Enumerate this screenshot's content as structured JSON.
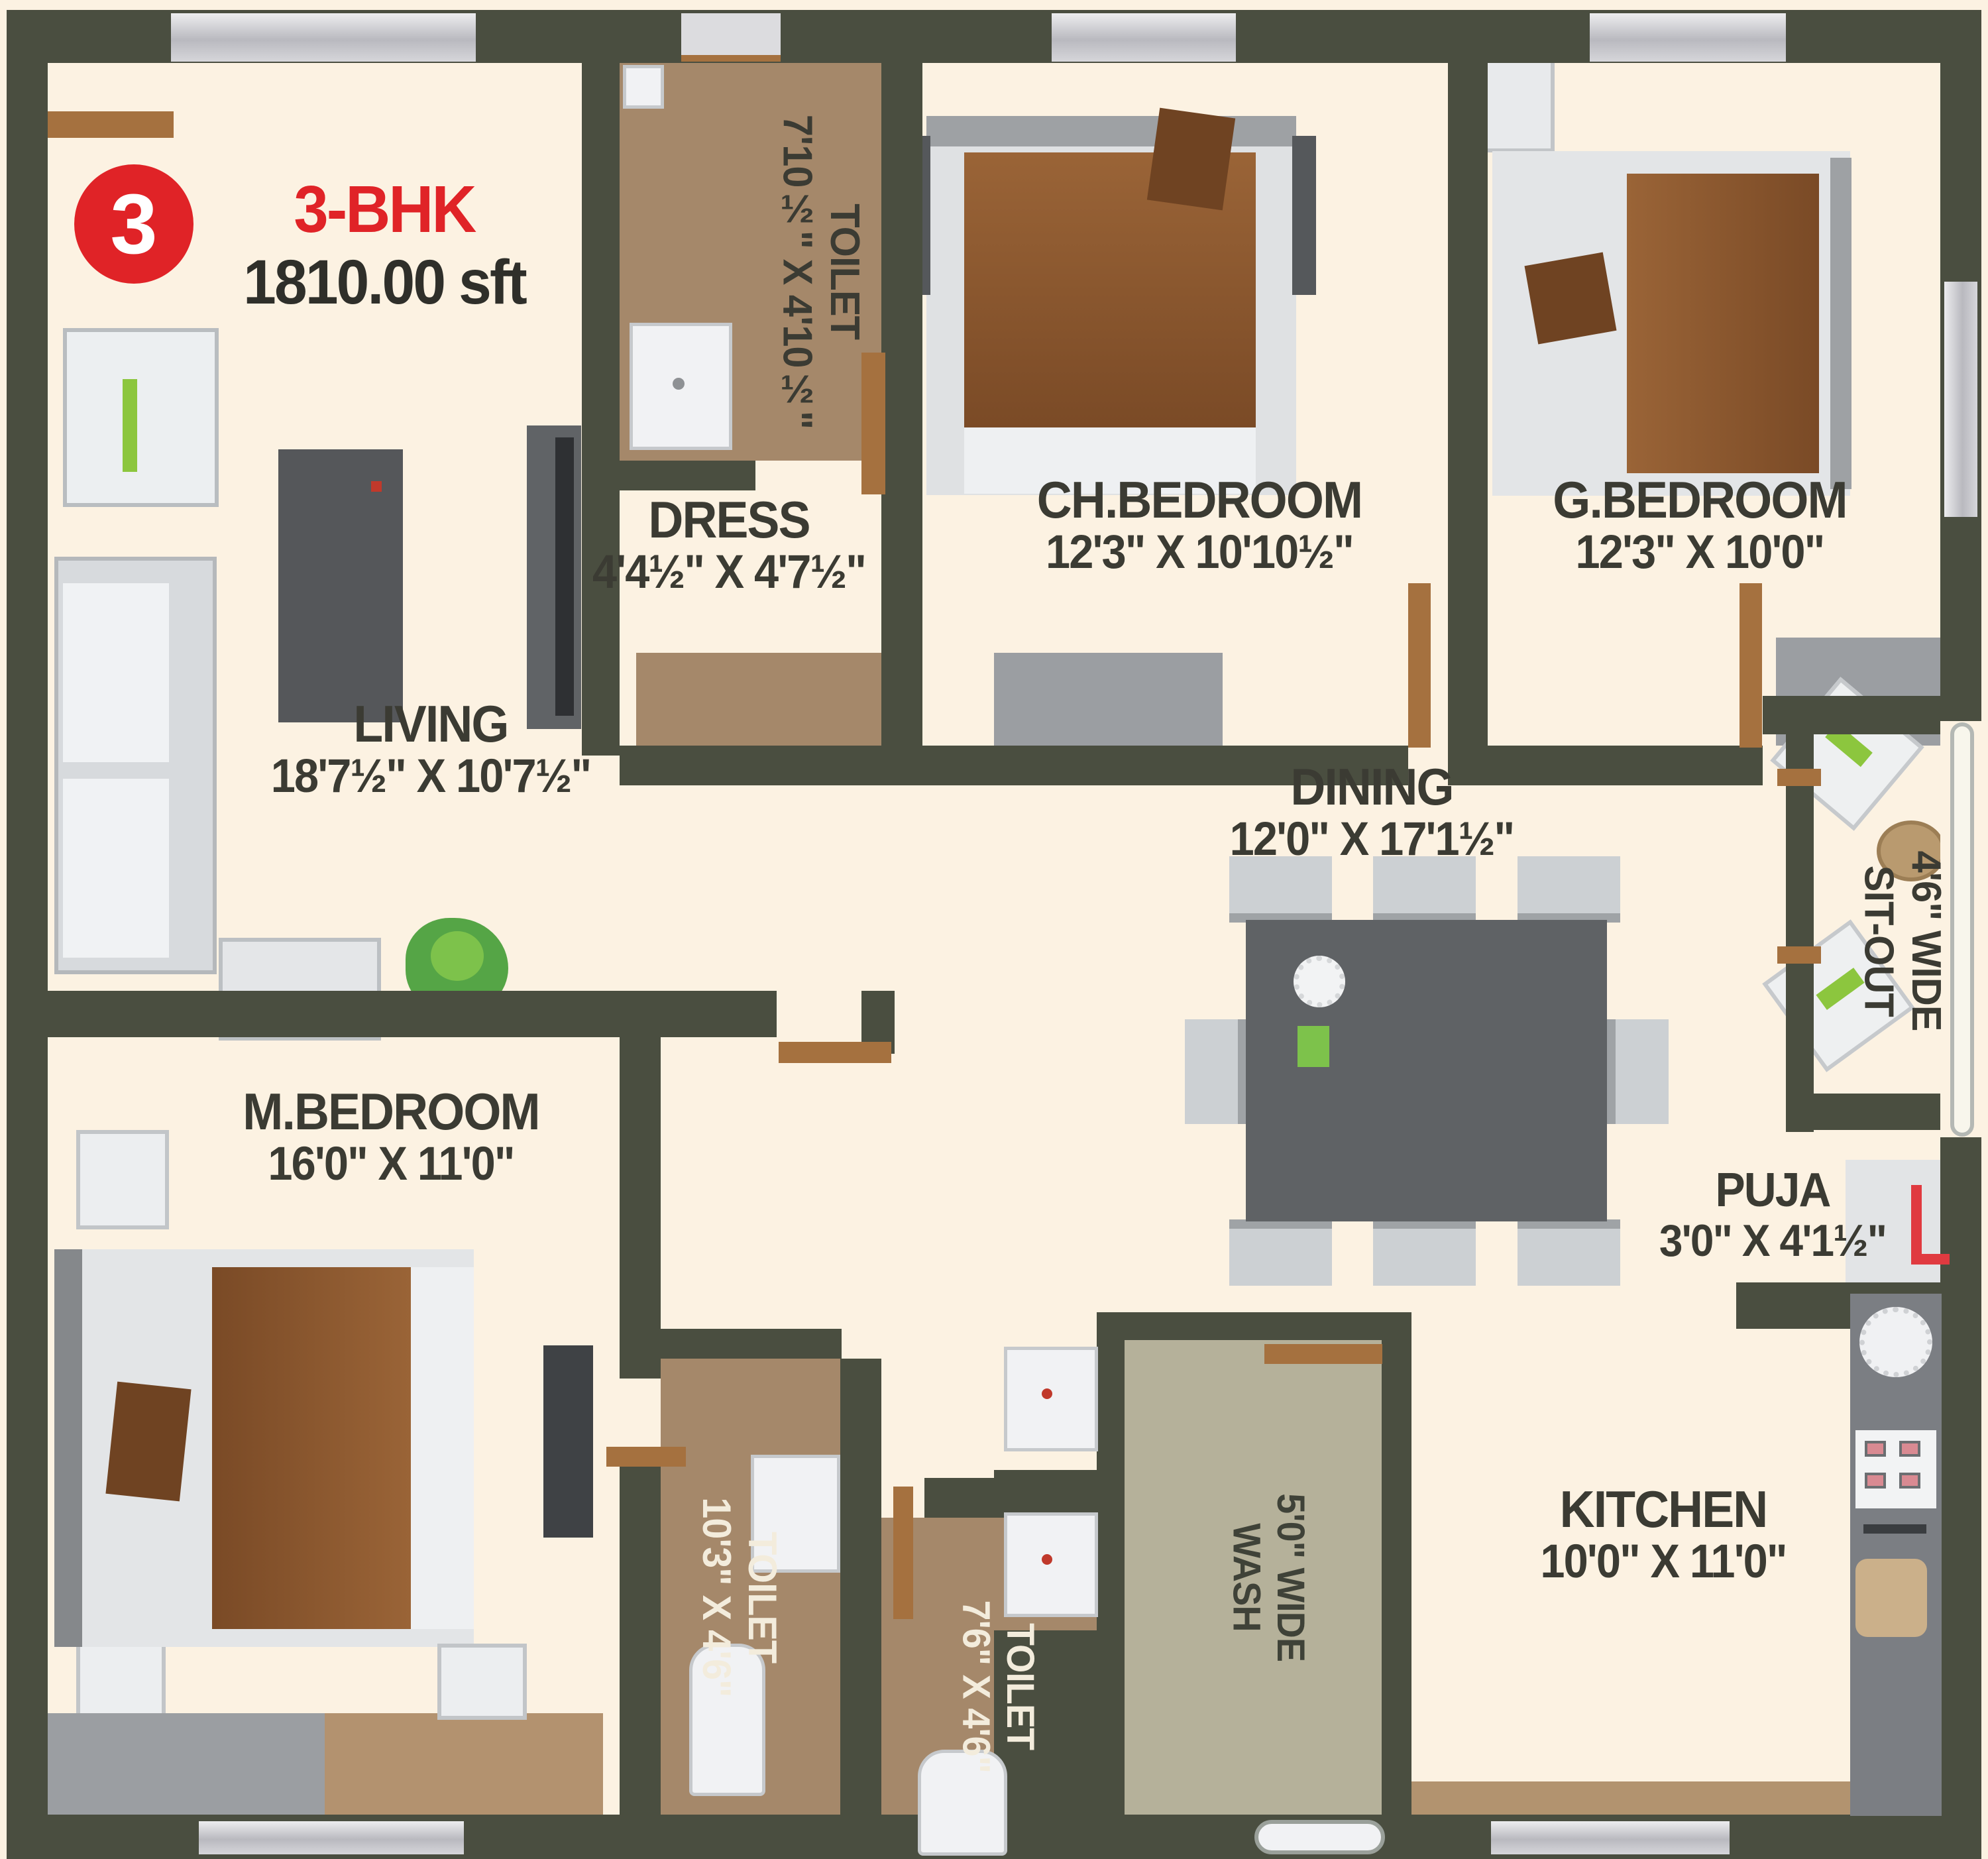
{
  "plan": {
    "unit_number": "3",
    "unit_type": "3-BHK",
    "unit_area": "1810.00 sft"
  },
  "rooms": {
    "living": {
      "name": "LIVING",
      "dims": "18'7½\" X 10'7½\""
    },
    "toilet_top": {
      "name": "TOILET",
      "dims": "7'10½\" X 4'10½\""
    },
    "dress": {
      "name": "DRESS",
      "dims": "4'4½\" X 4'7½\""
    },
    "ch_bedroom": {
      "name": "CH.BEDROOM",
      "dims": "12'3\" X 10'10½\""
    },
    "g_bedroom": {
      "name": "G.BEDROOM",
      "dims": "12'3\" X 10'0\""
    },
    "dining": {
      "name": "DINING",
      "dims": "12'0\" X 17'1½\""
    },
    "sit_out": {
      "name": "SIT-OUT",
      "dims": "4'6\" WIDE"
    },
    "m_bedroom": {
      "name": "M.BEDROOM",
      "dims": "16'0\" X 11'0\""
    },
    "puja": {
      "name": "PUJA",
      "dims": "3'0\" X 4'1½\""
    },
    "toilet_master": {
      "name": "TOILET",
      "dims": "10'3\" X 4'6\""
    },
    "toilet_common": {
      "name": "TOILET",
      "dims": "7'6\" X 4'6\""
    },
    "wash": {
      "name": "WASH",
      "dims": "5'0\" WIDE"
    },
    "kitchen": {
      "name": "KITCHEN",
      "dims": "10'0\" X 11'0\""
    }
  },
  "colors": {
    "accent_red": "#e02327",
    "wall": "#4a4e40",
    "floor_cream": "#fcf2e2",
    "toilet_floor": "#a5886a",
    "wash_floor": "#b5b19a",
    "wood_brown": "#a5713f",
    "blanket_brown": "#8a5a33",
    "furniture_grey": "#9b9ea2",
    "text_dark": "#3b3b33",
    "text_light": "#f3ecdc"
  }
}
